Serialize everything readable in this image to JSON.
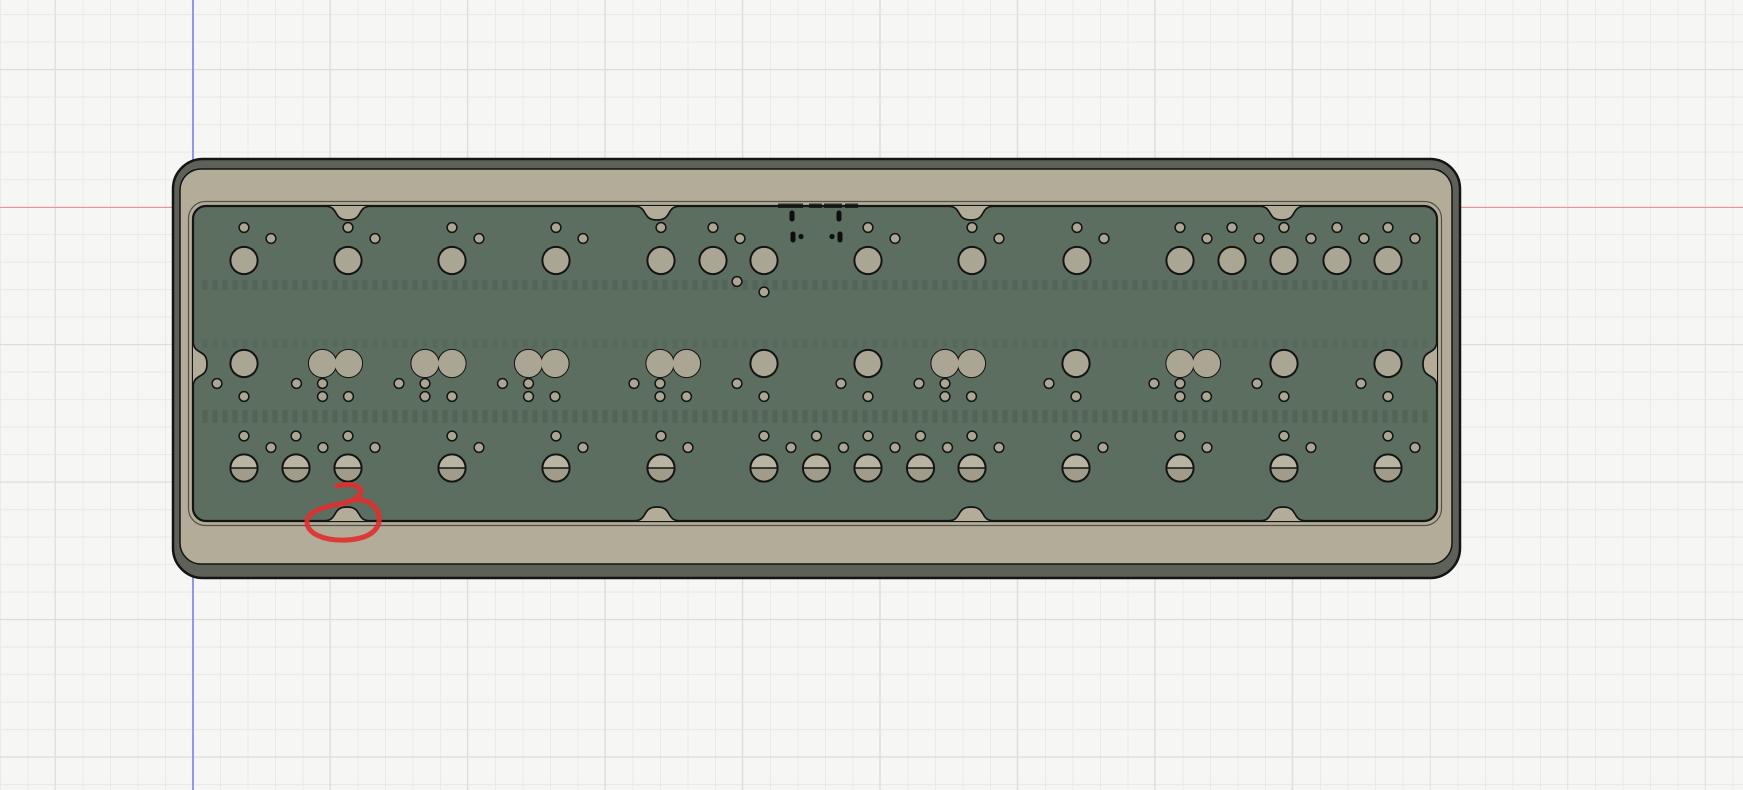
{
  "viewport": {
    "width": 1743,
    "height": 790,
    "background": "#f6f6f4",
    "grid": {
      "minor_step": 27.5,
      "major_step": 137.5,
      "minor_color": "#eaeae8",
      "major_color": "#dddddb",
      "origin_x": 192.5,
      "origin_y": 207
    },
    "axes": {
      "y_axis": {
        "x": 192,
        "color": "#9694ee"
      },
      "x_axis": {
        "y": 206.5,
        "color": "#f29090"
      }
    }
  },
  "model": {
    "description": "Bottom view of keyboard case with plate, mounting holes, screw bosses and USB cutout",
    "colors": {
      "outline": "#141414",
      "bevel": "#5d6157",
      "case_top": "#b2ac99",
      "hole_fill": "#aba593",
      "pcb_green": "#5c6e60",
      "screw_top": "#b9b3a2",
      "screw_bottom": "#a19c89",
      "usb_black": "#0e0e0e",
      "texture_dark": "rgba(0,0,0,0.10)"
    },
    "case_outer": {
      "x": 173,
      "y": 159,
      "w": 1287,
      "h": 419,
      "rx": 30
    },
    "case_inner": {
      "x": 180,
      "y": 169,
      "w": 1272,
      "h": 395,
      "rx": 21
    },
    "pcb": {
      "x": 193,
      "y": 206,
      "w": 1244,
      "h": 315,
      "rx": 13
    },
    "notches": {
      "half_width": 24,
      "depth": 14,
      "top_x": [
        348,
        657,
        971,
        1282
      ],
      "bottom_x": [
        347,
        657,
        971,
        1283
      ],
      "left_y": [
        364
      ],
      "right_y": [
        364
      ]
    },
    "texture_bands": [
      {
        "y": 280,
        "h": 10,
        "opacity": 0.85
      },
      {
        "y": 339,
        "h": 9,
        "opacity": 0.45
      },
      {
        "y": 410,
        "h": 13,
        "opacity": 1
      }
    ],
    "hole_radius": 13.6,
    "small_hole_radius": 4.9,
    "row1": {
      "y": 260.5,
      "holes": [
        244,
        348,
        452,
        556,
        661,
        713,
        764,
        868,
        972,
        1077,
        1180,
        1232,
        1284,
        1337,
        1388
      ],
      "small_holes": [
        [
          244,
          227.5
        ],
        [
          271,
          238.5
        ],
        [
          348,
          227.5
        ],
        [
          375,
          238.5
        ],
        [
          452,
          227.5
        ],
        [
          479,
          238.5
        ],
        [
          556,
          227.5
        ],
        [
          583,
          238.5
        ],
        [
          661,
          227.5
        ],
        [
          713,
          227.5
        ],
        [
          740,
          238.5
        ],
        [
          737,
          281.5
        ],
        [
          764,
          292
        ],
        [
          868,
          227.5
        ],
        [
          895,
          238.5
        ],
        [
          972,
          227.5
        ],
        [
          999,
          238.5
        ],
        [
          1077,
          227.5
        ],
        [
          1104,
          238.5
        ],
        [
          1180,
          227.5
        ],
        [
          1207,
          238.5
        ],
        [
          1232,
          227.5
        ],
        [
          1259,
          238.5
        ],
        [
          1284,
          227.5
        ],
        [
          1311,
          238.5
        ],
        [
          1337,
          227.5
        ],
        [
          1364,
          238.5
        ],
        [
          1388,
          227.5
        ],
        [
          1415,
          238.5
        ]
      ]
    },
    "row2": {
      "y": 363.5,
      "singles": [
        244,
        764,
        868,
        1076,
        1284,
        1388
      ],
      "pairs": [
        [
          322.5,
          348.5
        ],
        [
          425,
          452
        ],
        [
          528.5,
          555
        ],
        [
          660,
          686.5
        ],
        [
          945,
          971.5
        ],
        [
          1180,
          1206.5
        ]
      ],
      "small_holes": [
        [
          217,
          383.5
        ],
        [
          244,
          396.5
        ],
        [
          296.5,
          383.5
        ],
        [
          322.5,
          383.5
        ],
        [
          322.5,
          396.5
        ],
        [
          348.5,
          396.5
        ],
        [
          399,
          383.5
        ],
        [
          425,
          383.5
        ],
        [
          425,
          396.5
        ],
        [
          452,
          396.5
        ],
        [
          502.5,
          383.5
        ],
        [
          528.5,
          383.5
        ],
        [
          528.5,
          396.5
        ],
        [
          555,
          396.5
        ],
        [
          634,
          383.5
        ],
        [
          660,
          383.5
        ],
        [
          660,
          396.5
        ],
        [
          686.5,
          396.5
        ],
        [
          737,
          383.5
        ],
        [
          764,
          396.5
        ],
        [
          841,
          383.5
        ],
        [
          868,
          396.5
        ],
        [
          919,
          383.5
        ],
        [
          945,
          383.5
        ],
        [
          945,
          396.5
        ],
        [
          971.5,
          396.5
        ],
        [
          1049,
          383.5
        ],
        [
          1076,
          396.5
        ],
        [
          1154,
          383.5
        ],
        [
          1180,
          383.5
        ],
        [
          1180,
          396.5
        ],
        [
          1206.5,
          396.5
        ],
        [
          1257,
          383.5
        ],
        [
          1284,
          396.5
        ],
        [
          1361,
          383.5
        ],
        [
          1388,
          396.5
        ]
      ]
    },
    "row3": {
      "y": 468,
      "screw_holes": [
        244,
        296,
        348,
        452,
        556,
        661,
        764,
        816.5,
        868,
        920.5,
        972,
        1076,
        1180,
        1284,
        1388
      ],
      "small_holes": [
        [
          244,
          436
        ],
        [
          271,
          447.5
        ],
        [
          296,
          436
        ],
        [
          323,
          447.5
        ],
        [
          348,
          436
        ],
        [
          375,
          447.5
        ],
        [
          452,
          436
        ],
        [
          479,
          447.5
        ],
        [
          556,
          436
        ],
        [
          583,
          447.5
        ],
        [
          661,
          436
        ],
        [
          688,
          447.5
        ],
        [
          764,
          436
        ],
        [
          791,
          447.5
        ],
        [
          816.5,
          436
        ],
        [
          843.5,
          447.5
        ],
        [
          868,
          436
        ],
        [
          895,
          447.5
        ],
        [
          920.5,
          436
        ],
        [
          947.5,
          447.5
        ],
        [
          972,
          436
        ],
        [
          999,
          447.5
        ],
        [
          1076,
          436
        ],
        [
          1103,
          447.5
        ],
        [
          1180,
          436
        ],
        [
          1207,
          447.5
        ],
        [
          1284,
          436
        ],
        [
          1311,
          447.5
        ],
        [
          1388,
          436
        ],
        [
          1415,
          447.5
        ]
      ]
    },
    "usb": {
      "slots": [
        {
          "x": 792,
          "y": 216
        },
        {
          "x": 839,
          "y": 216
        },
        {
          "x": 793,
          "y": 237
        },
        {
          "x": 840,
          "y": 237
        }
      ],
      "slot_w": 5,
      "slot_h": 11,
      "dots": [
        {
          "x": 801,
          "y": 236.5
        },
        {
          "x": 832,
          "y": 236.5
        }
      ],
      "dot_r": 2.6,
      "rim_marks": [
        [
          778,
          803
        ],
        [
          809,
          822
        ],
        [
          824,
          842
        ],
        [
          845,
          858
        ]
      ],
      "rim_y": 203.5,
      "rim_h": 4.5
    },
    "annotation": {
      "color": "#df2f2f",
      "stroke_width": 5,
      "path": "M 337 486 C 352 482 366 487 359 495 C 355 500 347 503 340 504 C 322 507 308 512 307 521 C 306 533 323 541 346 540 C 370 539 381 529 379 516 C 377 504 365 498 353 500"
    }
  }
}
